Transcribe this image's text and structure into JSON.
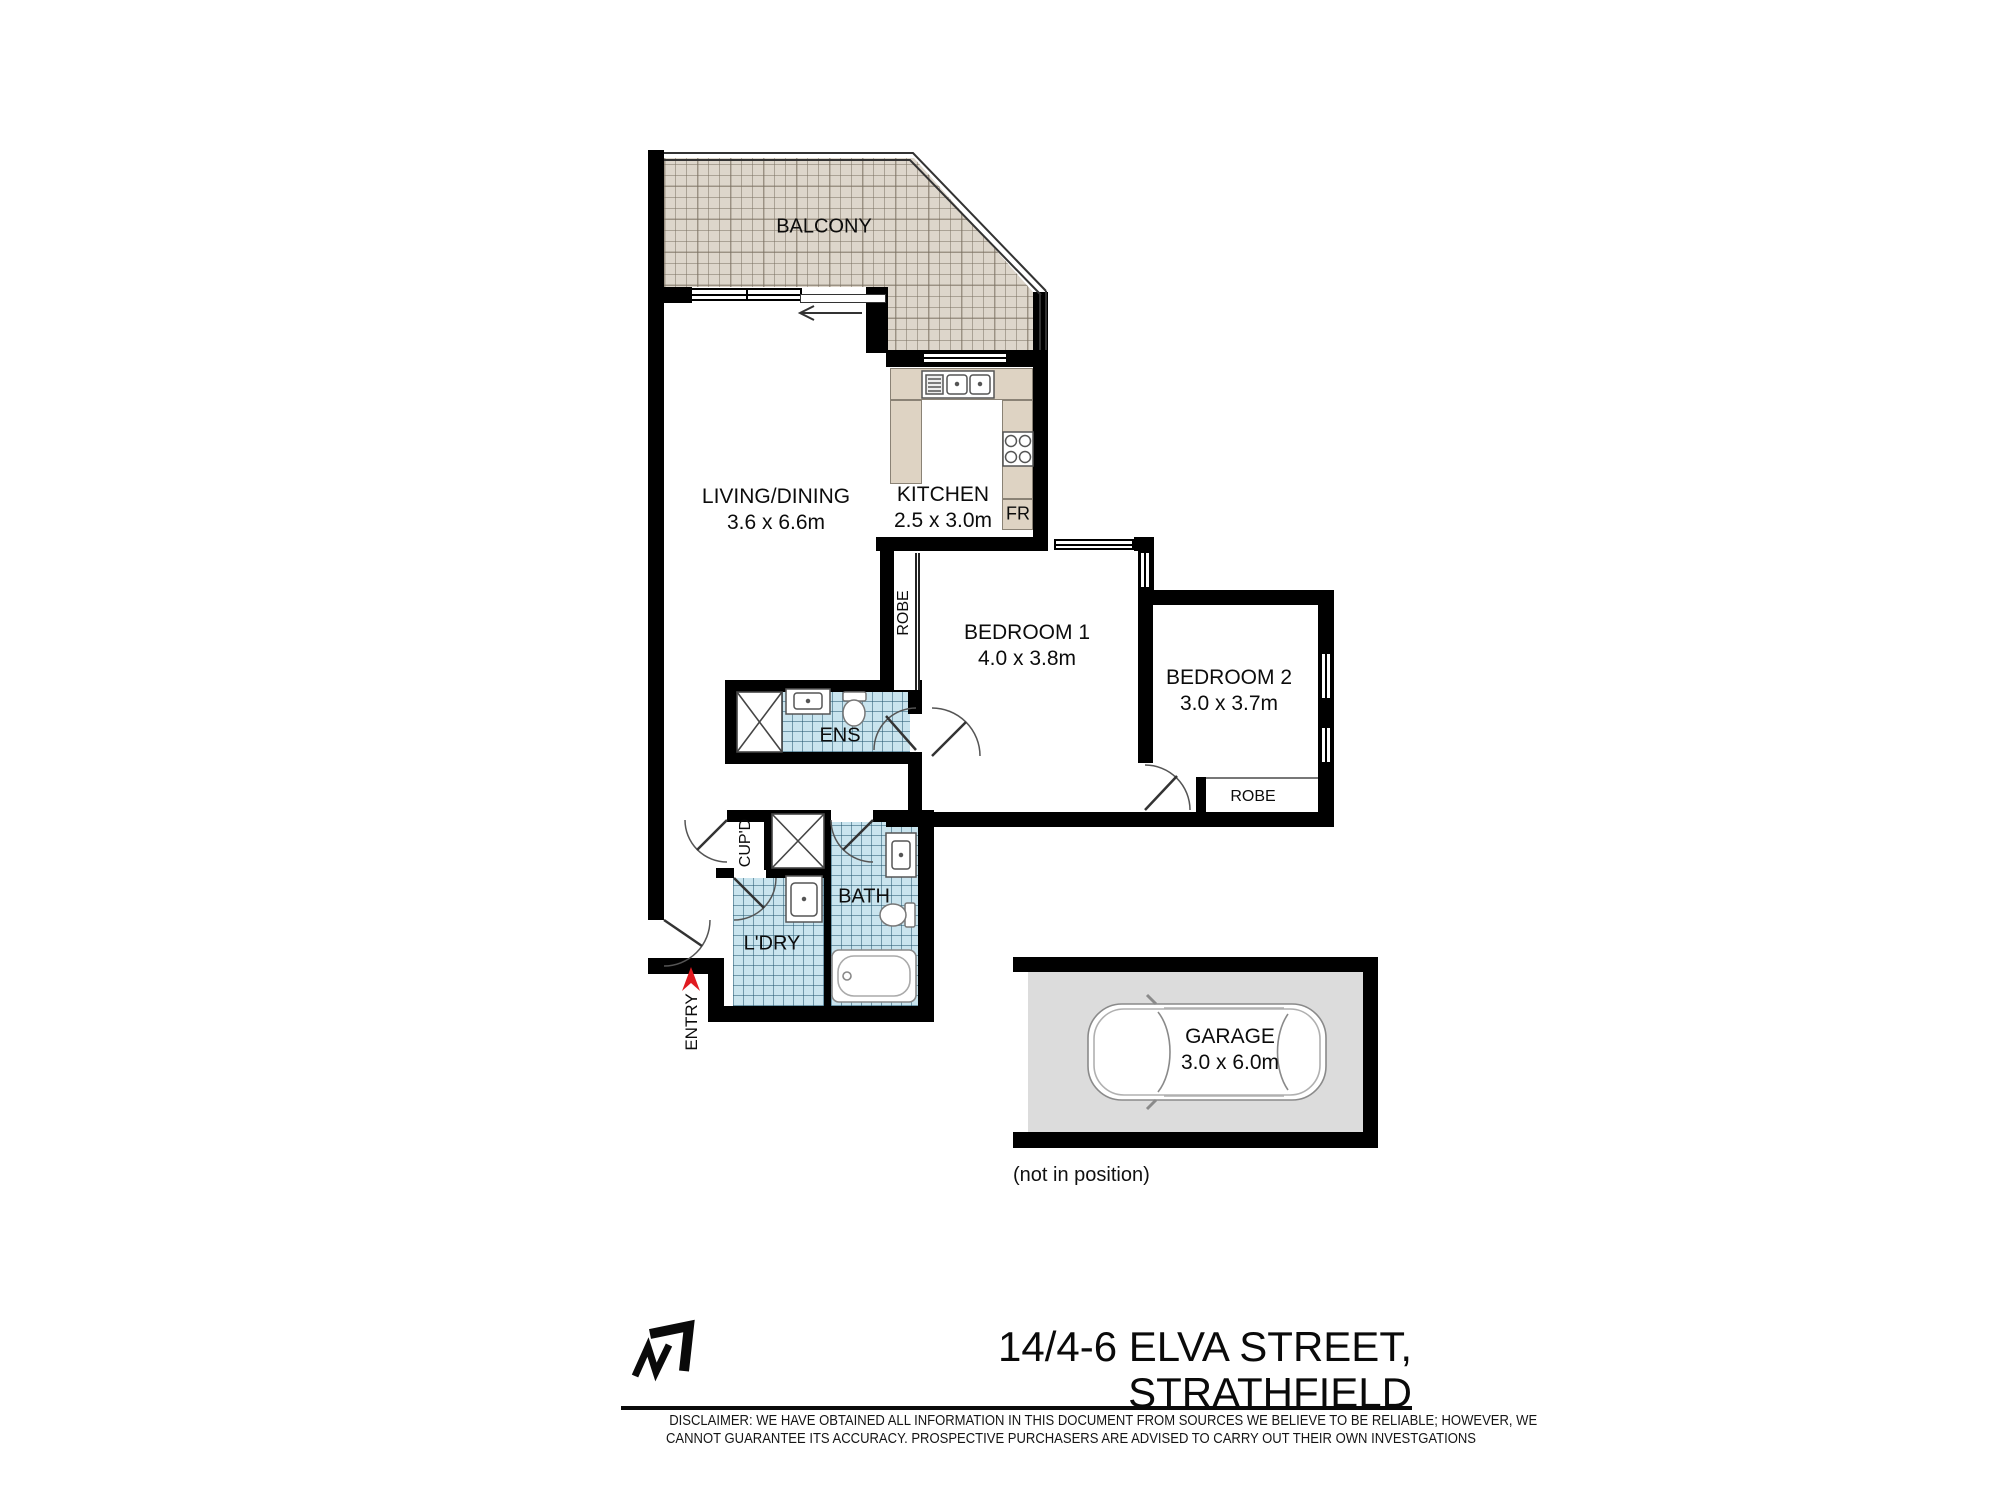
{
  "rooms": {
    "balcony": "BALCONY",
    "living": "LIVING/DINING",
    "living_dims": "3.6 x 6.6m",
    "kitchen": "KITCHEN",
    "kitchen_dims": "2.5 x 3.0m",
    "fridge": "FR",
    "bedroom1": "BEDROOM 1",
    "bedroom1_dims": "4.0 x 3.8m",
    "bedroom2": "BEDROOM 2",
    "bedroom2_dims": "3.0 x 3.7m",
    "robe_bedroom1": "ROBE",
    "robe_bedroom2": "ROBE",
    "ensuite": "ENS",
    "cupboard": "CUP'D",
    "bath": "BATH",
    "laundry": "L'DRY",
    "entry": "ENTRY",
    "garage": "GARAGE",
    "garage_dims": "3.0 x 6.0m",
    "garage_note": "(not in position)"
  },
  "footer": {
    "address_line1": "14/4-6 ELVA STREET,",
    "address_line2": "STRATHFIELD",
    "disclaimer_line1": "DISCLAIMER: WE HAVE OBTAINED ALL INFORMATION IN THIS DOCUMENT FROM SOURCES WE BELIEVE TO BE RELIABLE; HOWEVER, WE",
    "disclaimer_line2": "CANNOT GUARANTEE ITS ACCURACY. PROSPECTIVE PURCHASERS ARE ADVISED TO CARRY OUT THEIR OWN INVESTGATIONS"
  },
  "icons": {
    "north_arrow": "north-arrow-icon",
    "entry_arrow": "entry-direction-arrow",
    "car": "car-top-view-icon"
  },
  "colors": {
    "wall": "#000000",
    "balcony_tile": "#ddd6cb",
    "wet_area_tile": "#c9e4ee",
    "kitchen_counter": "#ded3c3",
    "garage_floor": "#dcdcdc",
    "entry_arrow": "#e01a20"
  }
}
